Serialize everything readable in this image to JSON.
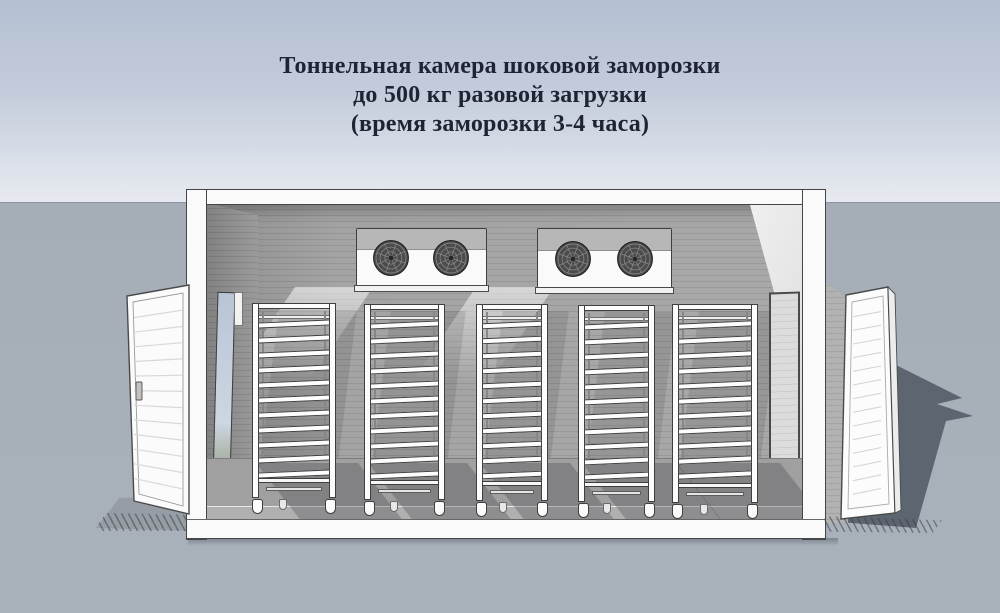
{
  "title": {
    "line1": "Тоннельная камера шоковой заморозки",
    "line2": "до 500 кг разовой загрузки",
    "line3": "(время заморозки 3-4 часа)"
  },
  "scene": {
    "subject": "tunnel shock freezing chamber, 3D cutaway view",
    "capacity_kg_label": "500",
    "freezing_time_label": "3-4",
    "evaporators": {
      "count": 2,
      "fans_per_unit": 2
    },
    "racks": {
      "count": 5,
      "trays_per_rack": 11,
      "casters_per_rack": 2
    },
    "doors": {
      "left": "open hinged insulated door",
      "right": "door panel leaning on right wall"
    }
  },
  "colors": {
    "sky_top": "#b4bfd1",
    "sky_bottom": "#e7eaf0",
    "ground": "#a5aeb7",
    "horizon_line": "#8d95a0",
    "title_text": "#1f2435",
    "wall_gray": "#a4a4a4",
    "wall_line": "#959595",
    "frame_white": "#fafafa",
    "outline_dark": "#454545",
    "fan_dark": "#4c4c4c",
    "floor_gray": "#a0a0a0",
    "shadow_dark": "#5d6670",
    "door_white": "#fbfbfb",
    "doorway_sky": "#b9c4d4"
  }
}
